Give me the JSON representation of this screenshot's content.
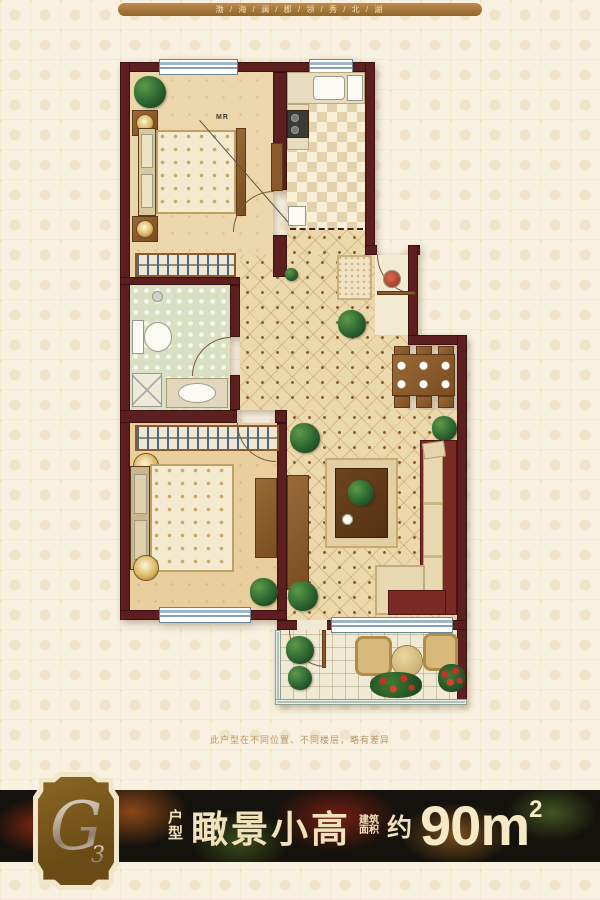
{
  "ribbon": {
    "text": "渤 / 海 / 澜 / 郡 / 领 / 秀 / 北 / 湖"
  },
  "plan": {
    "bed_label": "MR"
  },
  "disclaimer": "此户型在不同位置、不同楼层，略有差异",
  "footer": {
    "badge": {
      "letter": "G",
      "number": "3"
    },
    "unit_label_top": "户",
    "unit_label_bottom": "型",
    "title": "瞰景小高",
    "area_prefix_line1": "建筑",
    "area_prefix_line2": "面积",
    "approx": "约",
    "area_value": "90m",
    "area_sup": "2"
  },
  "colors": {
    "wall": "#5c1f1f",
    "ribbon_brown": "#9c712f",
    "band_background": "#14120c",
    "badge_brown": "#6b4b15",
    "cream_text": "#f2e2bb",
    "background": "#f8f1e1"
  }
}
